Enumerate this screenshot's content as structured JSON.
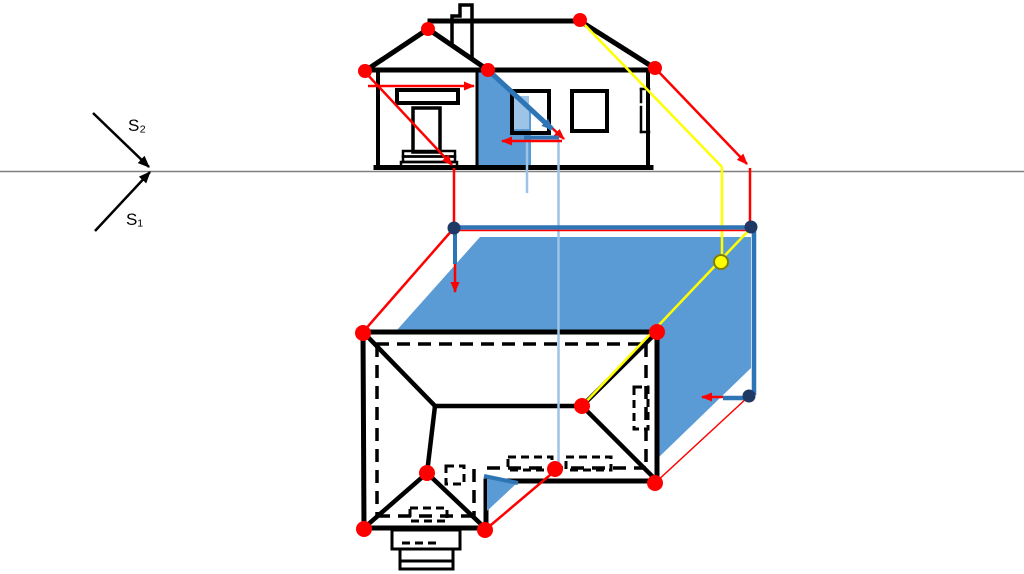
{
  "diagram": {
    "labels": {
      "ray_upper": "S₂",
      "ray_lower": "S₁"
    },
    "colors": {
      "background": "#FFFFFF",
      "drawing_black": "#000000",
      "ground_line": "#808080",
      "ray_red": "#FF0000",
      "ray_yellow": "#FFFF00",
      "construction_blue": "#2E75B6",
      "projection_blue": "#9DC3E6",
      "shadow_fill": "#5B9BD5",
      "shadow_fill_light": "#9DC3E6",
      "marker_red": "#FF0000",
      "marker_navy": "#1F3864",
      "marker_yellow_fill": "#FFFF00",
      "marker_yellow_stroke": "#808000"
    }
  }
}
